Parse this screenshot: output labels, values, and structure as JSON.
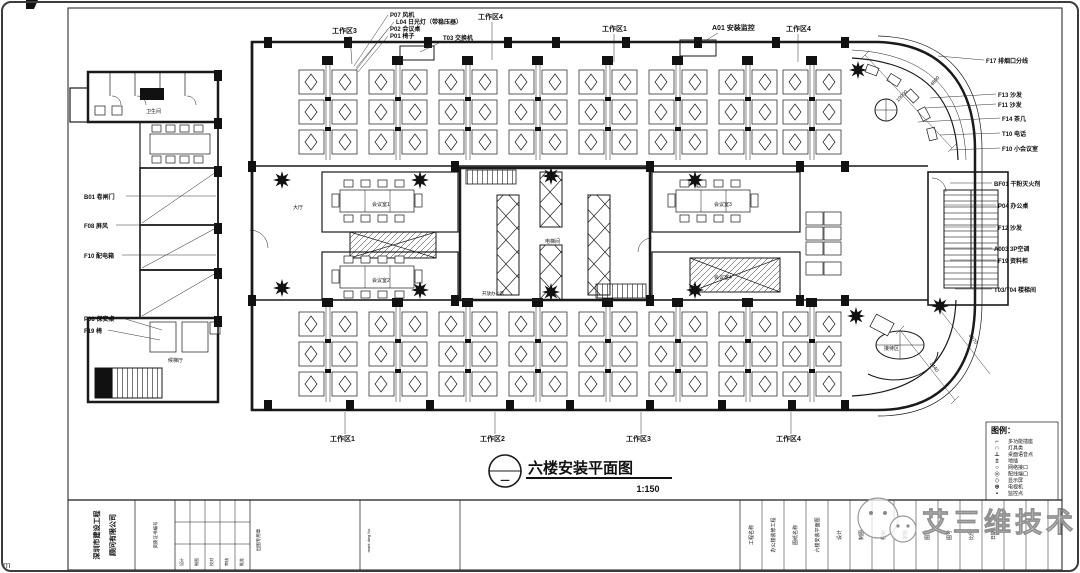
{
  "drawing": {
    "title": "六楼安装平面图",
    "scale": "1:150",
    "bubble_mark": "一"
  },
  "legend": {
    "header": "图例：",
    "items": [
      {
        "sym": "⌐",
        "label": "多功能插座"
      },
      {
        "sym": "∩",
        "label": "灯具类"
      },
      {
        "sym": "⊥",
        "label": "桌面语音点"
      },
      {
        "sym": "±",
        "label": "地插"
      },
      {
        "sym": "○",
        "label": "网络接口"
      },
      {
        "sym": "◎",
        "label": "配线端口"
      },
      {
        "sym": "◇",
        "label": "显示屏"
      },
      {
        "sym": "⊕",
        "label": "电视机"
      },
      {
        "sym": "▪",
        "label": "监控点"
      }
    ]
  },
  "callouts": {
    "top": [
      "工作区3",
      "P07 风机",
      "L04 日光灯（带稳压器）",
      "P02 会议桌",
      "P01 椅子",
      "T03 交换机",
      "工作区4",
      "工作区1",
      "A01 安装监控",
      "工作区4"
    ],
    "right": [
      "F17 排烟口分线",
      "F13 沙发",
      "F11 沙发",
      "F14 茶几",
      "T10 电话",
      "F10 小会议室",
      "BF01 干粉灭火剂",
      "P04 办公桌",
      "F12 沙发",
      "A003 3P空调",
      "F19 资料柜",
      "T03/T04 楼梯间"
    ],
    "left": [
      "B01 卷闸门",
      "F08 屏风",
      "F10 配电箱",
      "P08 保安桌",
      "F19 椅"
    ],
    "bottom": [
      "工作区1",
      "工作区2",
      "工作区3",
      "工作区4"
    ],
    "interior": [
      "卫生间",
      "大厅",
      "会议室1",
      "会议室2",
      "电梯间",
      "会议室3",
      "会议室4",
      "开放办公区",
      "候梯厅",
      "接待区"
    ],
    "dims": [
      "10000",
      "4600",
      "2440",
      "2070"
    ]
  },
  "title_block": {
    "company": [
      "深圳市建设工程",
      "顾问有限公司"
    ],
    "cert": "资质证书编号",
    "sign_labels": [
      "设计",
      "制图",
      "校对",
      "审核",
      "批准"
    ],
    "stamp": "出图专用章",
    "mark": "mark dwg No.",
    "fields": [
      "工程名称",
      "办公楼装修工程",
      "图纸名称",
      "六楼安装平面图",
      "设计",
      "制图",
      "校对",
      "审核",
      "图别",
      "图号",
      "比例",
      "日期"
    ]
  },
  "watermark": {
    "text": "艾三维技术"
  },
  "corner_mark": "m"
}
